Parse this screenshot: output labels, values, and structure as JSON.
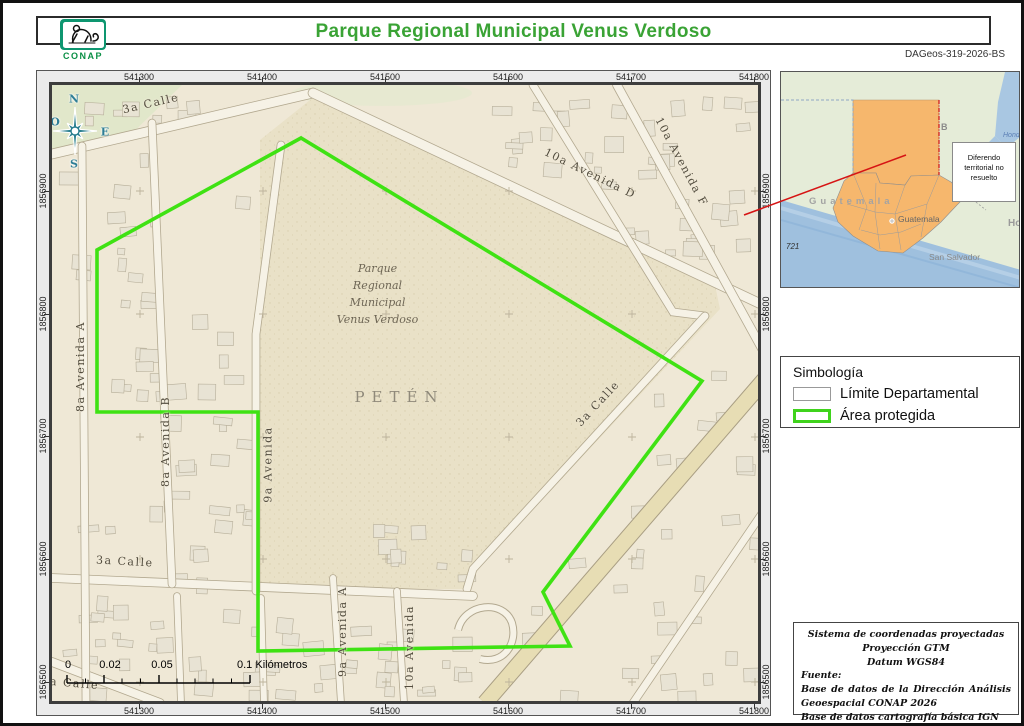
{
  "header": {
    "title": "Parque Regional Municipal Venus Verdoso",
    "logo_text": "CONAP",
    "doc_id": "DAGeos-319-2026-BS"
  },
  "map": {
    "grid": {
      "x_labels": [
        "541300",
        "541400",
        "541500",
        "541600",
        "541700",
        "541800"
      ],
      "y_labels": [
        "1856900",
        "1856800",
        "1856700",
        "1856600",
        "1856500"
      ]
    },
    "compass": {
      "n": "N",
      "e": "E",
      "s": "S",
      "o": "O"
    },
    "street_labels": [
      "3a Calle",
      "10a Avenida F",
      "10a Avenida D",
      "8a Avenida A",
      "8a Avenida B",
      "9a Avenida",
      "3a Calle",
      "3a Calle",
      "9a Avenida A",
      "10a Avenida",
      "a Calle"
    ],
    "park_label_lines": [
      "Parque",
      "Regional",
      "Municipal",
      "Venus Verdoso"
    ],
    "department_label": "PETÉN",
    "scale_bar": {
      "labels": [
        "0",
        "0.02",
        "0.05",
        "0.1"
      ],
      "unit": "Kilómetros"
    }
  },
  "inset": {
    "note_lines": [
      "Diferendo",
      "territorial no",
      "resuelto"
    ],
    "country_label": "Guatemala",
    "capital_label": "Guatemala",
    "san_salvador_label": "San Salvador",
    "honduras_partial": "Ho",
    "belize_partial": "B",
    "blue_partial": "Hond",
    "number_label": "721"
  },
  "legend": {
    "title": "Simbología",
    "items": [
      {
        "label": "Límite Departamental"
      },
      {
        "label": "Área protegida"
      }
    ]
  },
  "source_box": {
    "line1": "Sistema de coordenadas proyectadas",
    "line2": "Proyección GTM",
    "line3": "Datum WGS84",
    "fuente_label": "Fuente:",
    "source1": "Base de datos de la Dirección Análisis Geoespacial CONAP 2026",
    "source2": "Base de datos cartografía básica IGN 2010"
  },
  "colors": {
    "accent_green": "#3aa335",
    "protected_area_green": "#3fe213",
    "highlight_orange": "#f6b76d",
    "annotation_red": "#d61414",
    "compass_teal": "#2a7f8f"
  }
}
